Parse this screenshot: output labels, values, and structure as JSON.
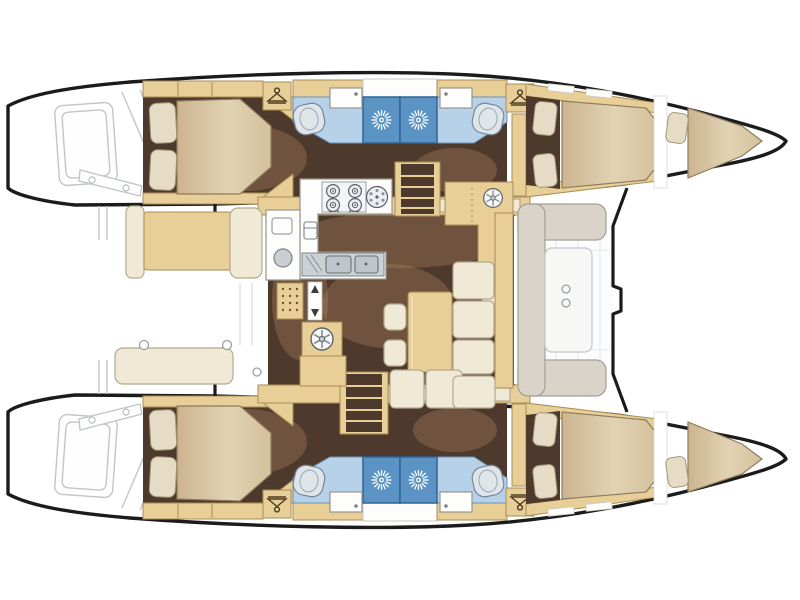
{
  "diagram": {
    "label": "Catamaran interior layout floor plan, top view, bow to the right",
    "type": "boat-floor-plan",
    "cabins_count": "4",
    "bathrooms_count": "4"
  },
  "rooms": {
    "aft_cabin_top": "Aft double cabin, top hull",
    "fwd_cabin_top": "Forward double cabin, top hull",
    "forepeak_top": "Forepeak berth, top hull",
    "bathroom_top": "Twin bathrooms with central showers, top hull",
    "aft_cabin_bottom": "Aft double cabin, bottom hull",
    "fwd_cabin_bottom": "Forward double cabin, bottom hull",
    "forepeak_bottom": "Forepeak berth, bottom hull",
    "bathroom_bottom": "Twin bathrooms with central showers, bottom hull",
    "salon": "Salon with galley and dinette",
    "galley": "Galley with stove and double sink",
    "dinette": "L-shaped dinette sofa with table",
    "fwd_cockpit": "Forward cockpit lounge seat",
    "aft_cockpit": "Aft cockpit with benches",
    "transom_top": "Transom steps sketch, top hull",
    "transom_bottom": "Transom steps sketch, bottom hull"
  },
  "icons": {
    "shower": "shower-rose-icon",
    "hanger": "wardrobe-hanger-icon",
    "toilet": "toilet-fixture",
    "sink": "washbasin",
    "stove": "four-burner-stove-icon",
    "round_burner": "round-hob-icon",
    "double_sink": "double-sink-icon",
    "fridge": "fridge-icon",
    "washer": "washing-machine-icon",
    "vent": "vent-wheel-icon",
    "stairs": "companionway-stairs",
    "doormat": "dotted-doormat",
    "arrows": "up-down-passage-arrows",
    "cupholders": "cup-holder-dots",
    "davits": "dinghy-davit-lines"
  },
  "colors": {
    "outline": "#1b1b1b",
    "sketch": "#c2c5c9",
    "wood": "#e8ce97",
    "woodDark": "#a98e55",
    "floor": "#4e392d",
    "rug": "#b68d63",
    "cream": "#f0e9d6",
    "creamDark": "#b2a98f",
    "pillow": "#e6dcc6",
    "blueFloor": "#b7d2e8",
    "blueFloorDark": "#6b93b8",
    "shower": "#5b94c4",
    "showerDark": "#2f6394",
    "seatGray": "#d9d3ca",
    "seatGrayDark": "#a59e94",
    "counter": "#fdfdfc",
    "counterDark": "#97948c",
    "steel": "#ccd1d6",
    "fixture": "#e0e5ea",
    "fixtureDark": "#77879a"
  }
}
